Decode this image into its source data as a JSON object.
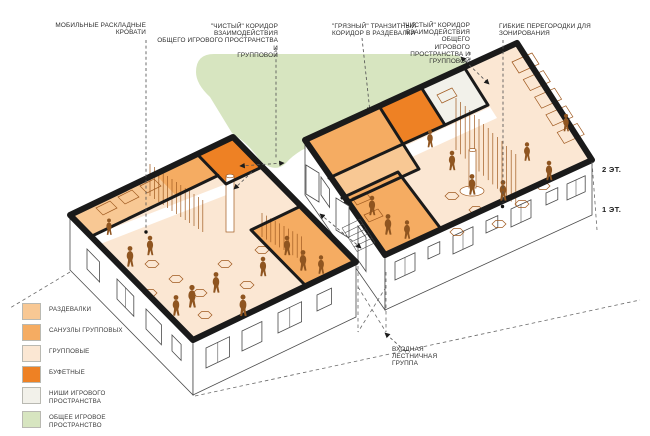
{
  "colors": {
    "peach": "#FBE7D3",
    "light_orange": "#F8C894",
    "mid_orange": "#F5AC62",
    "dark_orange": "#EE8124",
    "off_white": "#F2F1EA",
    "green": "#D7E5C0",
    "wall": "#1A1A1A",
    "furniture": "#A05A20",
    "people": "#8F5520",
    "facade_line": "#4a4a4a",
    "dash": "#555555",
    "text": "#2e2e2e"
  },
  "annotations": {
    "beds": {
      "lines": [
        "МОБИЛЬНЫЕ РАСКЛАДНЫЕ",
        "КРОВАТИ"
      ]
    },
    "clean_corridor_left": {
      "lines": [
        "\"ЧИСТЫЙ\" КОРИДОР ВЗАИМОДЕЙСТВИЯ",
        "ОБЩЕГО ИГРОВОГО ПРОСТРАНСТВА И",
        "ГРУППОВОЙ"
      ]
    },
    "dirty_corridor": {
      "lines": [
        "\"ГРЯЗНЫЙ\" ТРАНЗИТНЫЙ",
        "КОРИДОР В РАЗДЕВАЛКИ"
      ]
    },
    "clean_corridor_right": {
      "lines": [
        "\"ЧИСТЫЙ\" КОРИДОР",
        "ВЗАИМОДЕЙСТВИЯ ОБЩЕГО",
        "ИГРОВОГО ПРОСТРАНСТВА И",
        "ГРУППОВОЙ"
      ]
    },
    "partitions": {
      "lines": [
        "ГИБКИЕ ПЕРЕГОРОДКИ ДЛЯ",
        "ЗОНИРОВАНИЯ"
      ]
    },
    "entrance": {
      "lines": [
        "ВХОДНАЯ",
        "ЛЕСТНИЧНАЯ",
        "ГРУППА"
      ]
    }
  },
  "floor_labels": {
    "second": "2 ЭТ.",
    "first": "1 ЭТ."
  },
  "legend": {
    "items": [
      {
        "label": "РАЗДЕВАЛКИ",
        "color": "#F8C894"
      },
      {
        "label": "САНУЗЛЫ ГРУППОВЫХ",
        "color": "#F5AC62"
      },
      {
        "label": "ГРУППОВЫЕ",
        "color": "#FBE7D3"
      },
      {
        "label": "БУФЕТНЫЕ",
        "color": "#EE8124"
      },
      {
        "label": "НИШИ ИГРОВОГО ПРОСТРАНСТВА",
        "color": "#F2F1EA"
      },
      {
        "label": "ОБЩЕЕ ИГРОВОЕ ПРОСТРАНСТВО",
        "color": "#D7E5C0"
      }
    ]
  }
}
